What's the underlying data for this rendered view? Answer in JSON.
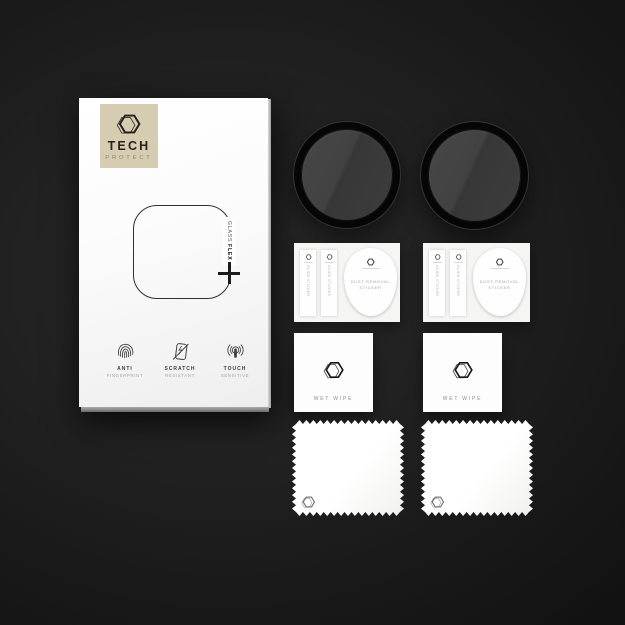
{
  "product": {
    "brand": {
      "name_top": "TECH",
      "name_bottom": "PROTECT"
    },
    "label": {
      "glass": "GLASS",
      "flex": "FLEX"
    },
    "features": [
      {
        "icon": "fingerprint-icon",
        "title": "ANTI",
        "subtitle": "FINGERPRINT"
      },
      {
        "icon": "scratch-icon",
        "title": "SCRATCH",
        "subtitle": "RESISTANT"
      },
      {
        "icon": "touch-icon",
        "title": "TOUCH",
        "subtitle": "SENSITIVE"
      }
    ]
  },
  "accessories": {
    "guide_sticker_label": "GUIDE STICKER",
    "dust_sticker": {
      "line1": "DUST REMOVAL",
      "line2": "STICKER"
    },
    "wet_wipe_label": "WET WIPE"
  },
  "colors": {
    "brand_badge_bg": "#d5ccb2",
    "background_center": "#2a2a2a",
    "background_edge": "#121212",
    "glass_ring": "#060606",
    "glass_face": "#414141",
    "box_face": "#ffffff"
  }
}
